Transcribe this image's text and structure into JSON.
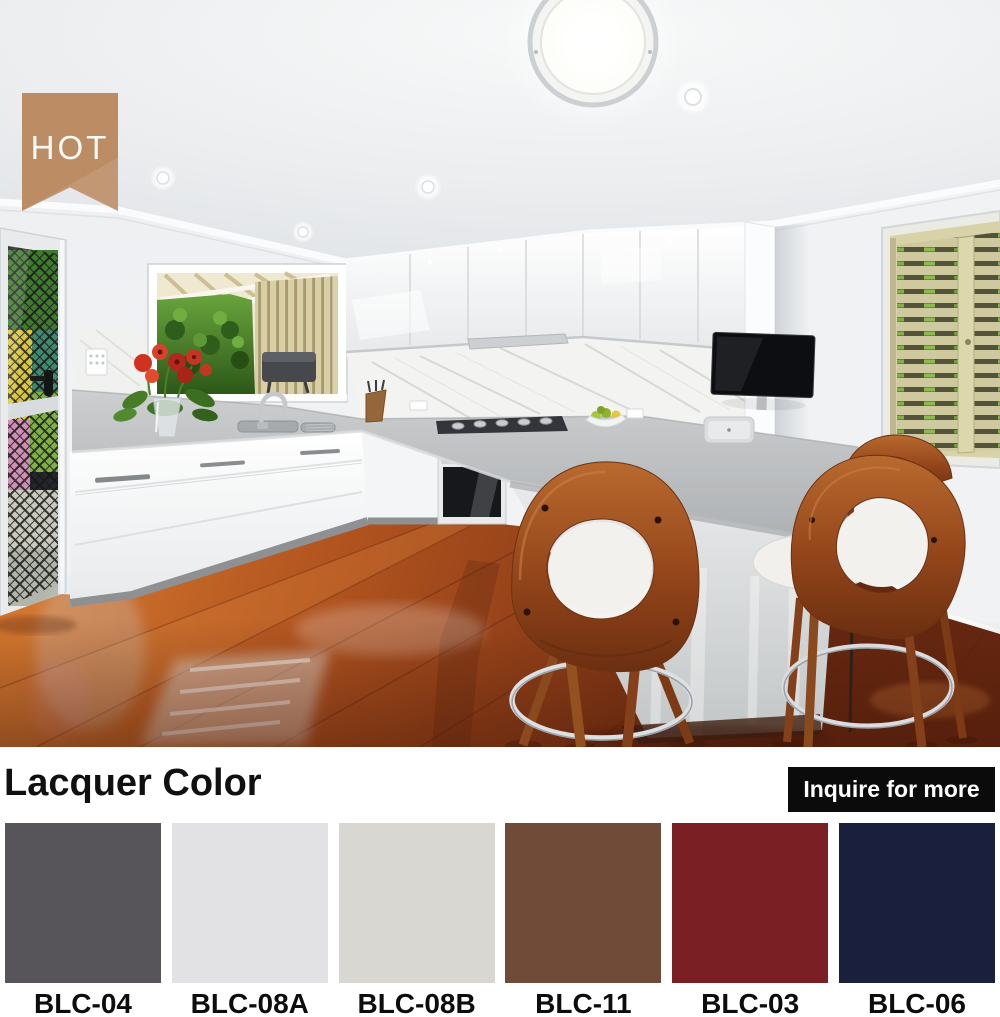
{
  "badge": {
    "label": "HOT",
    "bg": "#BC8C65"
  },
  "photo": {
    "description": "Modern kitchen with white gloss cabinets, grey stone benchtop, marble splashback, timber bar stools and polished hardwood floor"
  },
  "lacquer_section": {
    "title": "Lacquer Color",
    "button": {
      "label": "Inquire for more",
      "bg": "#0B0B0C",
      "text_color": "#FFFFFF"
    },
    "swatches": [
      {
        "code": "BLC-04",
        "color": "#57545A"
      },
      {
        "code": "BLC-08A",
        "color": "#E2E2E4"
      },
      {
        "code": "BLC-08B",
        "color": "#D8D7D2"
      },
      {
        "code": "BLC-11",
        "color": "#6F4B38"
      },
      {
        "code": "BLC-03",
        "color": "#7A2025"
      },
      {
        "code": "BLC-06",
        "color": "#1A1F3E"
      }
    ]
  }
}
